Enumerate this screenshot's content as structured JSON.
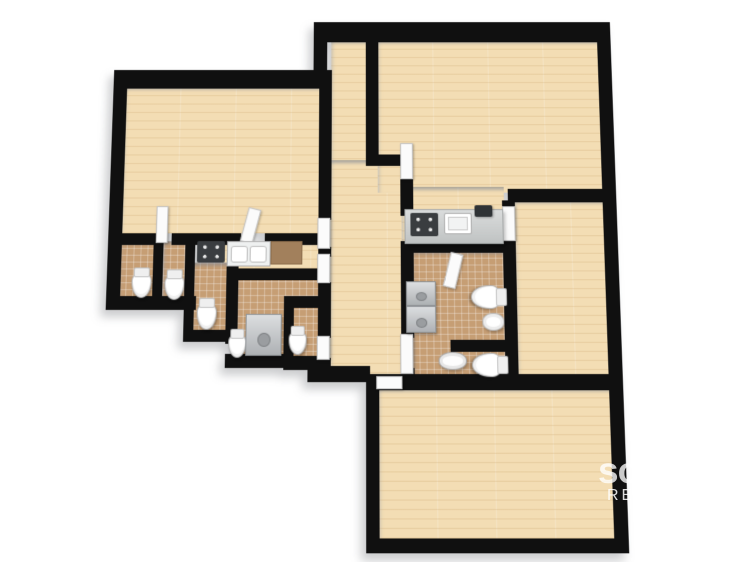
{
  "watermark": {
    "primary": "so",
    "secondary": "RE"
  },
  "palette": {
    "background": "#ffffff",
    "wall": "#101010",
    "wood_floor": "#f3ddb4",
    "tile_floor": "#c69e74",
    "counter_brown": "#a2805c",
    "appliance_dark": "#3a3d40",
    "door_white": "#fbfbfb"
  },
  "floorplan": {
    "rooms": [
      {
        "id": "living-room-left",
        "floor": "wood",
        "rect": [
          118,
          78,
          202,
          154
        ]
      },
      {
        "id": "corridor",
        "floor": "wood",
        "rect": [
          330,
          28,
          38,
          132
        ]
      },
      {
        "id": "hall",
        "floor": "wood",
        "rect": [
          330,
          156,
          74,
          220
        ]
      },
      {
        "id": "living-room-top",
        "floor": "wood",
        "rect": [
          378,
          28,
          230,
          162
        ]
      },
      {
        "id": "kitchen-zone",
        "floor": "wood",
        "rect": [
          402,
          184,
          104,
          58
        ]
      },
      {
        "id": "kitchenette-left",
        "floor": "wood",
        "rect": [
          196,
          240,
          126,
          28
        ]
      },
      {
        "id": "bedroom-right",
        "floor": "wood",
        "rect": [
          516,
          198,
          92,
          178
        ]
      },
      {
        "id": "living-room-bottom",
        "floor": "wood",
        "rect": [
          378,
          388,
          230,
          146
        ]
      },
      {
        "id": "wc-1",
        "floor": "tile",
        "rect": [
          118,
          240,
          36,
          58
        ]
      },
      {
        "id": "wc-2",
        "floor": "tile",
        "rect": [
          162,
          240,
          24,
          58
        ]
      },
      {
        "id": "wc-3",
        "floor": "tile",
        "rect": [
          192,
          262,
          36,
          70
        ]
      },
      {
        "id": "laundry-wc",
        "floor": "tile",
        "rect": [
          236,
          274,
          86,
          84
        ]
      },
      {
        "id": "bathroom-cluster",
        "floor": "tile",
        "rect": [
          412,
          250,
          94,
          128
        ]
      }
    ],
    "walls": [
      [
        312,
        8,
        300,
        22
      ],
      [
        606,
        8,
        14,
        538
      ],
      [
        312,
        10,
        14,
        70
      ],
      [
        113,
        60,
        218,
        20
      ],
      [
        106,
        60,
        14,
        250
      ],
      [
        106,
        296,
        90,
        14
      ],
      [
        152,
        240,
        10,
        66
      ],
      [
        184,
        240,
        10,
        100
      ],
      [
        226,
        252,
        12,
        92
      ],
      [
        184,
        330,
        58,
        12
      ],
      [
        108,
        232,
        46,
        12
      ],
      [
        170,
        232,
        70,
        12
      ],
      [
        264,
        232,
        58,
        12
      ],
      [
        226,
        268,
        96,
        12
      ],
      [
        284,
        306,
        10,
        62
      ],
      [
        226,
        354,
        68,
        14
      ],
      [
        284,
        296,
        38,
        12
      ],
      [
        284,
        356,
        40,
        14
      ],
      [
        318,
        60,
        13,
        158
      ],
      [
        318,
        246,
        13,
        10
      ],
      [
        318,
        282,
        13,
        56
      ],
      [
        318,
        358,
        13,
        16
      ],
      [
        366,
        18,
        13,
        134
      ],
      [
        366,
        150,
        40,
        12
      ],
      [
        401,
        174,
        13,
        40
      ],
      [
        401,
        240,
        116,
        12
      ],
      [
        401,
        252,
        13,
        86
      ],
      [
        401,
        368,
        13,
        12
      ],
      [
        504,
        198,
        13,
        192
      ],
      [
        450,
        340,
        67,
        12
      ],
      [
        510,
        186,
        110,
        14
      ],
      [
        366,
        374,
        254,
        16
      ],
      [
        366,
        374,
        13,
        172
      ],
      [
        366,
        533,
        254,
        14
      ],
      [
        308,
        366,
        62,
        16
      ]
    ],
    "doors": [
      {
        "id": "corridor-to-left-unit-1",
        "rect": [
          317,
          216,
          13,
          32
        ]
      },
      {
        "id": "corridor-to-left-unit-2",
        "rect": [
          317,
          253,
          13,
          30
        ]
      },
      {
        "id": "wc5-door",
        "rect": [
          317,
          336,
          13,
          24
        ]
      },
      {
        "id": "top-room-door",
        "rect": [
          401,
          138,
          13,
          38
        ]
      },
      {
        "id": "bath-cluster-door",
        "rect": [
          400,
          334,
          13,
          40
        ]
      },
      {
        "id": "entrance-door",
        "rect": [
          376,
          376,
          26,
          13
        ]
      },
      {
        "id": "bathroom-top-door",
        "rect": [
          447,
          252,
          13,
          36
        ],
        "rot": 14
      },
      {
        "id": "left-room-door-1",
        "rect": [
          154,
          204,
          12,
          38
        ]
      },
      {
        "id": "left-room-door-2",
        "rect": [
          243,
          206,
          13,
          36
        ],
        "rot": 14
      },
      {
        "id": "bedroom-door",
        "rect": [
          504,
          204,
          13,
          36
        ]
      }
    ],
    "fixtures": [
      {
        "id": "kitchen-counter",
        "kind": "counter-gray",
        "rect": [
          405,
          207,
          100,
          36
        ]
      },
      {
        "id": "stove-main",
        "kind": "stove",
        "rect": [
          411,
          211,
          28,
          24
        ]
      },
      {
        "id": "kitchen-sink",
        "kind": "sink-single",
        "rect": [
          445,
          211,
          28,
          22
        ]
      },
      {
        "id": "coffee-machine",
        "kind": "appliance",
        "rect": [
          476,
          203,
          18,
          12
        ]
      },
      {
        "id": "kitchenette-stove",
        "kind": "stove",
        "rect": [
          196,
          240,
          28,
          22
        ]
      },
      {
        "id": "kitchenette-sink",
        "kind": "sink-double",
        "rect": [
          226,
          240,
          44,
          26
        ]
      },
      {
        "id": "kitchenette-counter",
        "kind": "counter-brown",
        "rect": [
          270,
          240,
          32,
          24
        ]
      },
      {
        "id": "toilet-1",
        "kind": "toilet",
        "rect": [
          131,
          272,
          20,
          26
        ]
      },
      {
        "id": "toilet-2",
        "kind": "toilet",
        "rect": [
          164,
          274,
          20,
          26
        ]
      },
      {
        "id": "toilet-3",
        "kind": "toilet",
        "rect": [
          197,
          303,
          20,
          27
        ]
      },
      {
        "id": "toilet-4",
        "kind": "toilet",
        "rect": [
          229,
          334,
          18,
          24
        ]
      },
      {
        "id": "toilet-5",
        "kind": "toilet",
        "rect": [
          289,
          331,
          18,
          24
        ]
      },
      {
        "id": "toilet-6",
        "kind": "toilet",
        "rect": [
          474,
          282,
          24,
          30
        ],
        "rot": 90
      },
      {
        "id": "toilet-7",
        "kind": "toilet",
        "rect": [
          474,
          350,
          24,
          30
        ],
        "rot": 90
      },
      {
        "id": "bidet",
        "kind": "bidet",
        "rect": [
          482,
          313,
          22,
          18
        ]
      },
      {
        "id": "basin",
        "kind": "sink-oval",
        "rect": [
          438,
          352,
          28,
          18
        ]
      },
      {
        "id": "washer-1",
        "kind": "washer",
        "rect": [
          406,
          281,
          30,
          25
        ]
      },
      {
        "id": "washer-2",
        "kind": "washer",
        "rect": [
          406,
          306,
          30,
          27
        ]
      },
      {
        "id": "washer-3",
        "kind": "washer",
        "rect": [
          246,
          314,
          36,
          42
        ]
      }
    ]
  }
}
